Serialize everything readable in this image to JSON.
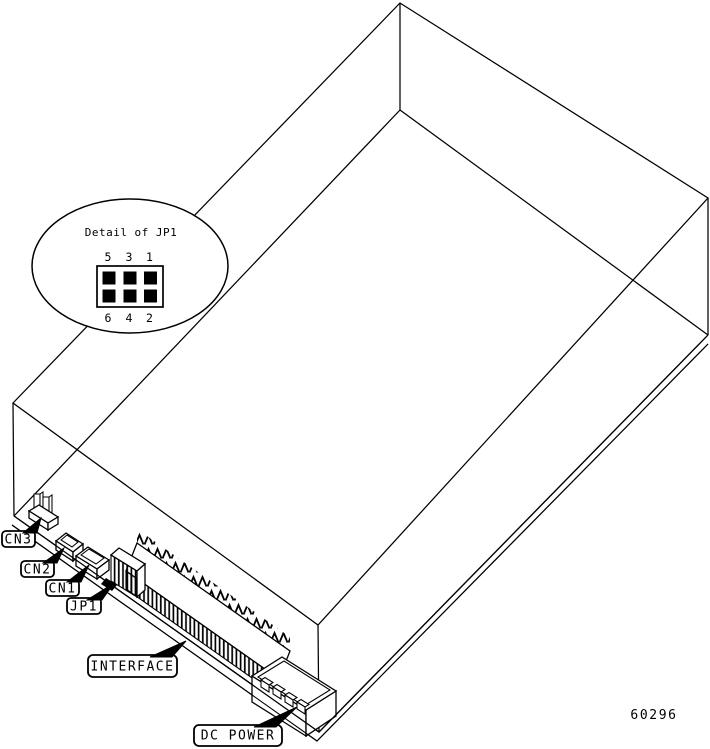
{
  "diagram": {
    "background_color": "#ffffff",
    "line_color": "#000000",
    "figure_number": "60296",
    "detail_balloon": {
      "title": "Detail of JP1",
      "pin_rows": 2,
      "pin_cols": 3,
      "pin_labels_top": [
        "5",
        "3",
        "1"
      ],
      "pin_labels_bottom": [
        "6",
        "4",
        "2"
      ]
    },
    "callouts": {
      "cn3": "CN3",
      "cn2": "CN2",
      "cn1": "CN1",
      "jp1": "JP1",
      "interface": "INTERFACE",
      "dc_power": "DC POWER"
    }
  }
}
